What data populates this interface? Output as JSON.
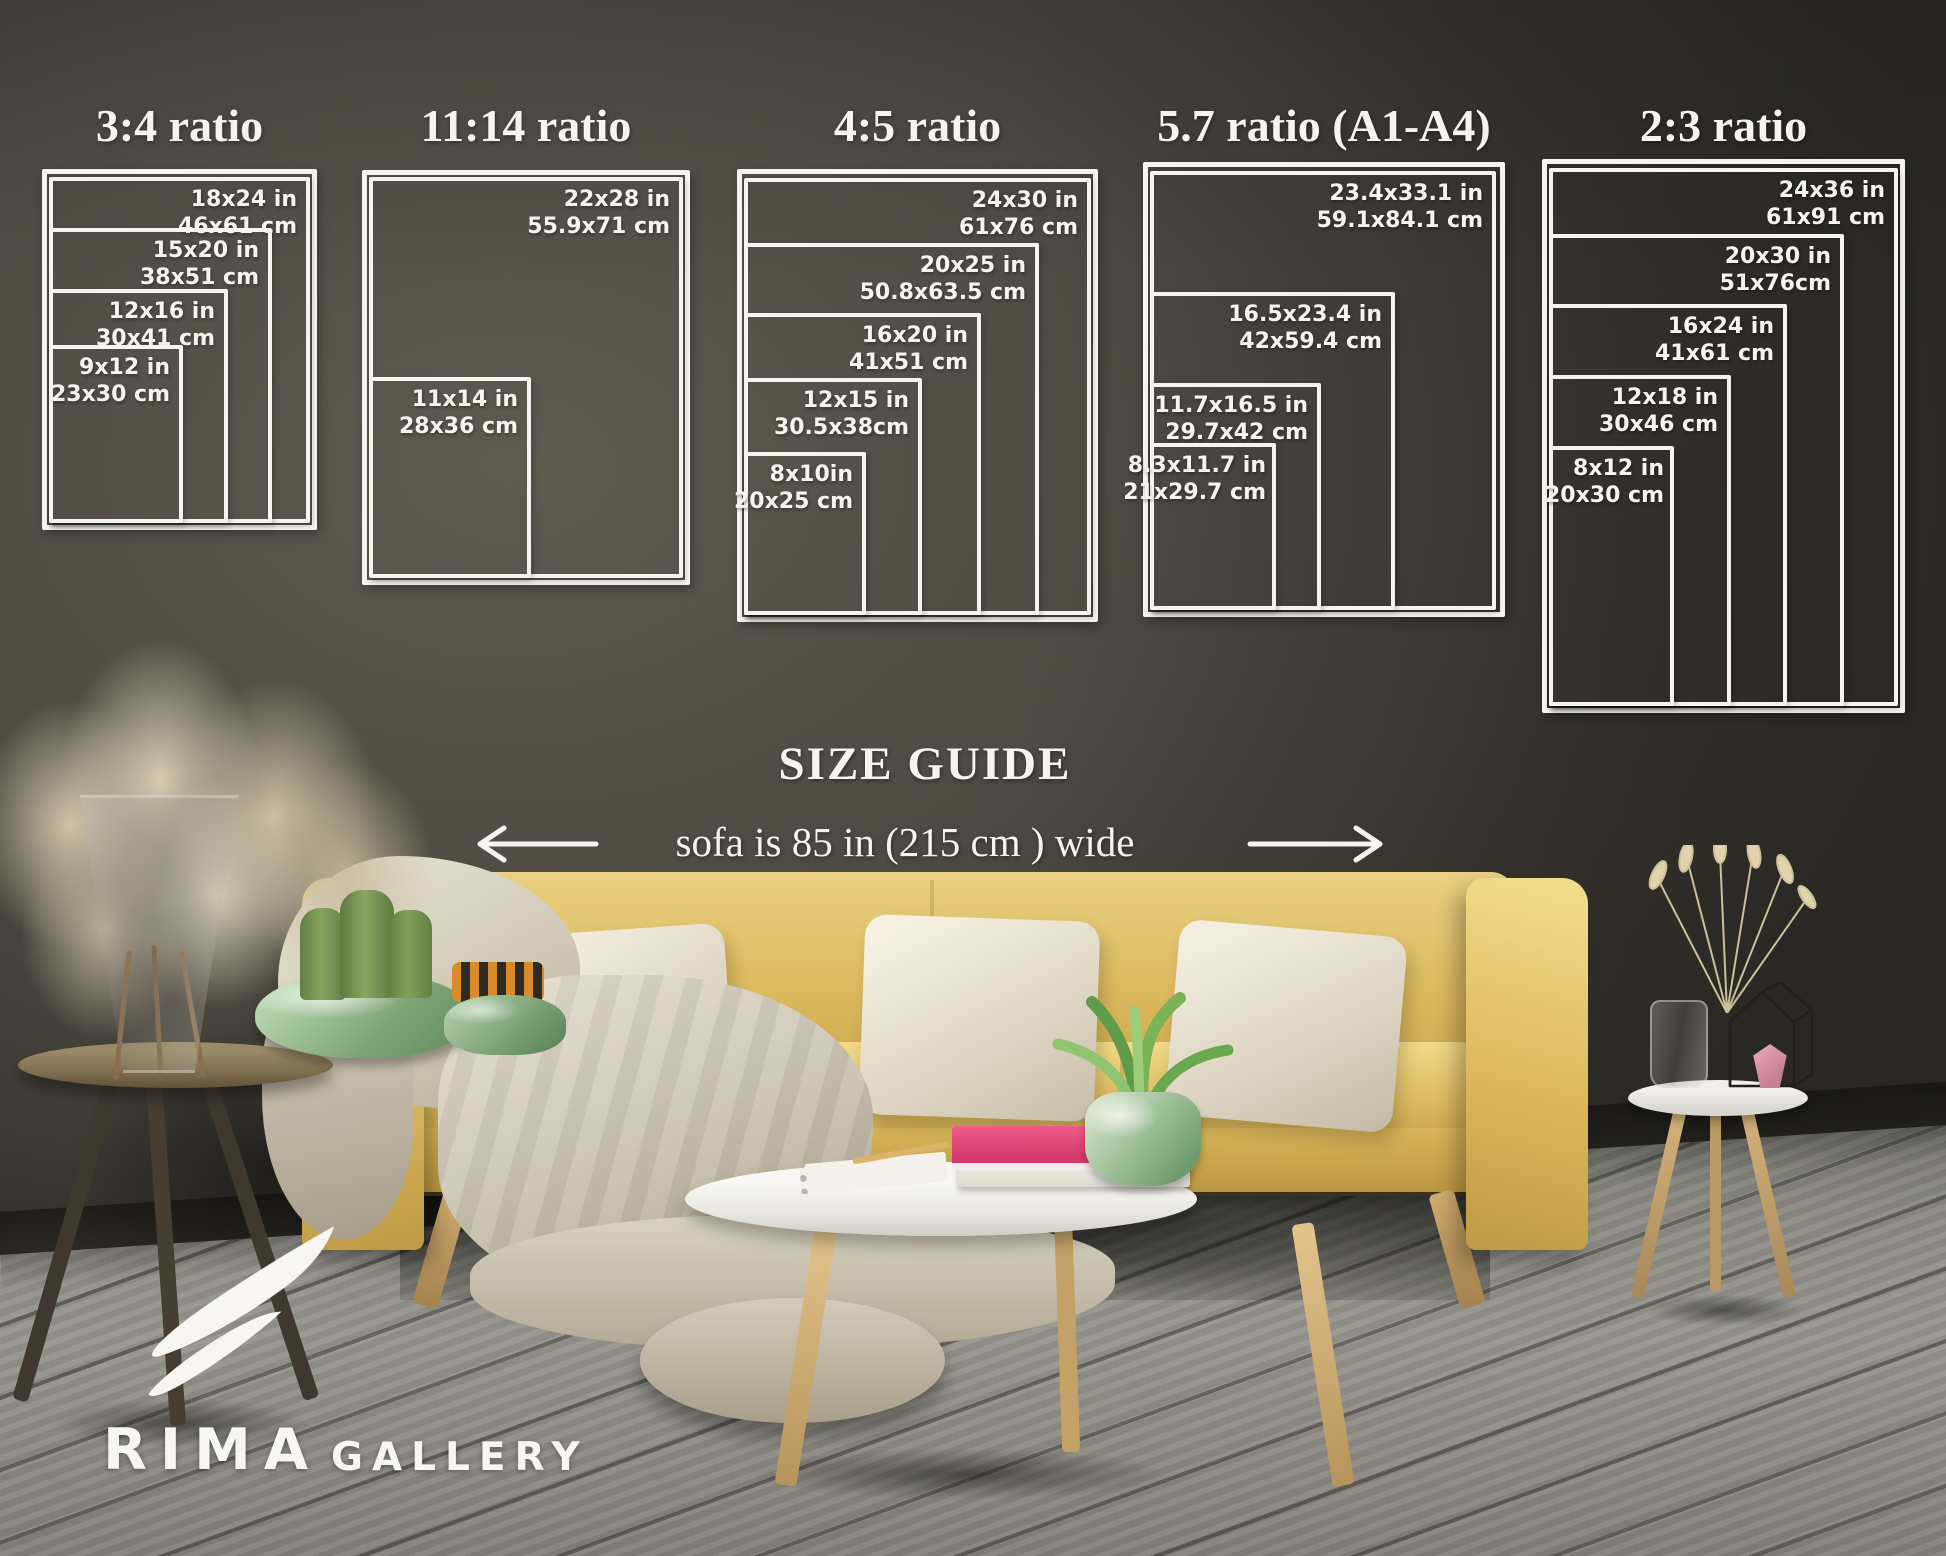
{
  "panels": [
    {
      "title": "3:4 ratio",
      "sizes": [
        {
          "inches": "18x24 in",
          "cm": "46x61 cm"
        },
        {
          "inches": "15x20 in",
          "cm": "38x51 cm"
        },
        {
          "inches": "12x16 in",
          "cm": "30x41 cm"
        },
        {
          "inches": "9x12 in",
          "cm": "23x30 cm"
        }
      ]
    },
    {
      "title": "11:14 ratio",
      "sizes": [
        {
          "inches": "22x28 in",
          "cm": "55.9x71 cm"
        },
        {
          "inches": "11x14 in",
          "cm": "28x36 cm"
        }
      ]
    },
    {
      "title": "4:5 ratio",
      "sizes": [
        {
          "inches": "24x30 in",
          "cm": "61x76 cm"
        },
        {
          "inches": "20x25 in",
          "cm": "50.8x63.5 cm"
        },
        {
          "inches": "16x20 in",
          "cm": "41x51 cm"
        },
        {
          "inches": "12x15 in",
          "cm": "30.5x38cm"
        },
        {
          "inches": "8x10in",
          "cm": "20x25 cm"
        }
      ]
    },
    {
      "title": "5.7 ratio (A1-A4)",
      "sizes": [
        {
          "inches": "23.4x33.1 in",
          "cm": "59.1x84.1 cm"
        },
        {
          "inches": "16.5x23.4 in",
          "cm": "42x59.4 cm"
        },
        {
          "inches": "11.7x16.5 in",
          "cm": "29.7x42 cm"
        },
        {
          "inches": "8.3x11.7 in",
          "cm": "21x29.7 cm"
        }
      ]
    },
    {
      "title": "2:3 ratio",
      "sizes": [
        {
          "inches": "24x36 in",
          "cm": "61x91 cm"
        },
        {
          "inches": "20x30 in",
          "cm": "51x76cm"
        },
        {
          "inches": "16x24 in",
          "cm": "41x61 cm"
        },
        {
          "inches": "12x18 in",
          "cm": "30x46 cm"
        },
        {
          "inches": "8x12 in",
          "cm": "20x30 cm"
        }
      ]
    }
  ],
  "guide": {
    "heading": "SIZE GUIDE",
    "sofa_note": "sofa is 85 in (215 cm ) wide"
  },
  "logo": {
    "brand": "RIMA",
    "suffix": "GALLERY"
  },
  "colors": {
    "line_white": "#f6f4ee",
    "sofa_yellow": "#dcba5e",
    "wall_gray": "#45423b",
    "floor_gray": "#8d8c86",
    "book_pink": "#e8457c",
    "pot_green": "#8fb08b"
  }
}
